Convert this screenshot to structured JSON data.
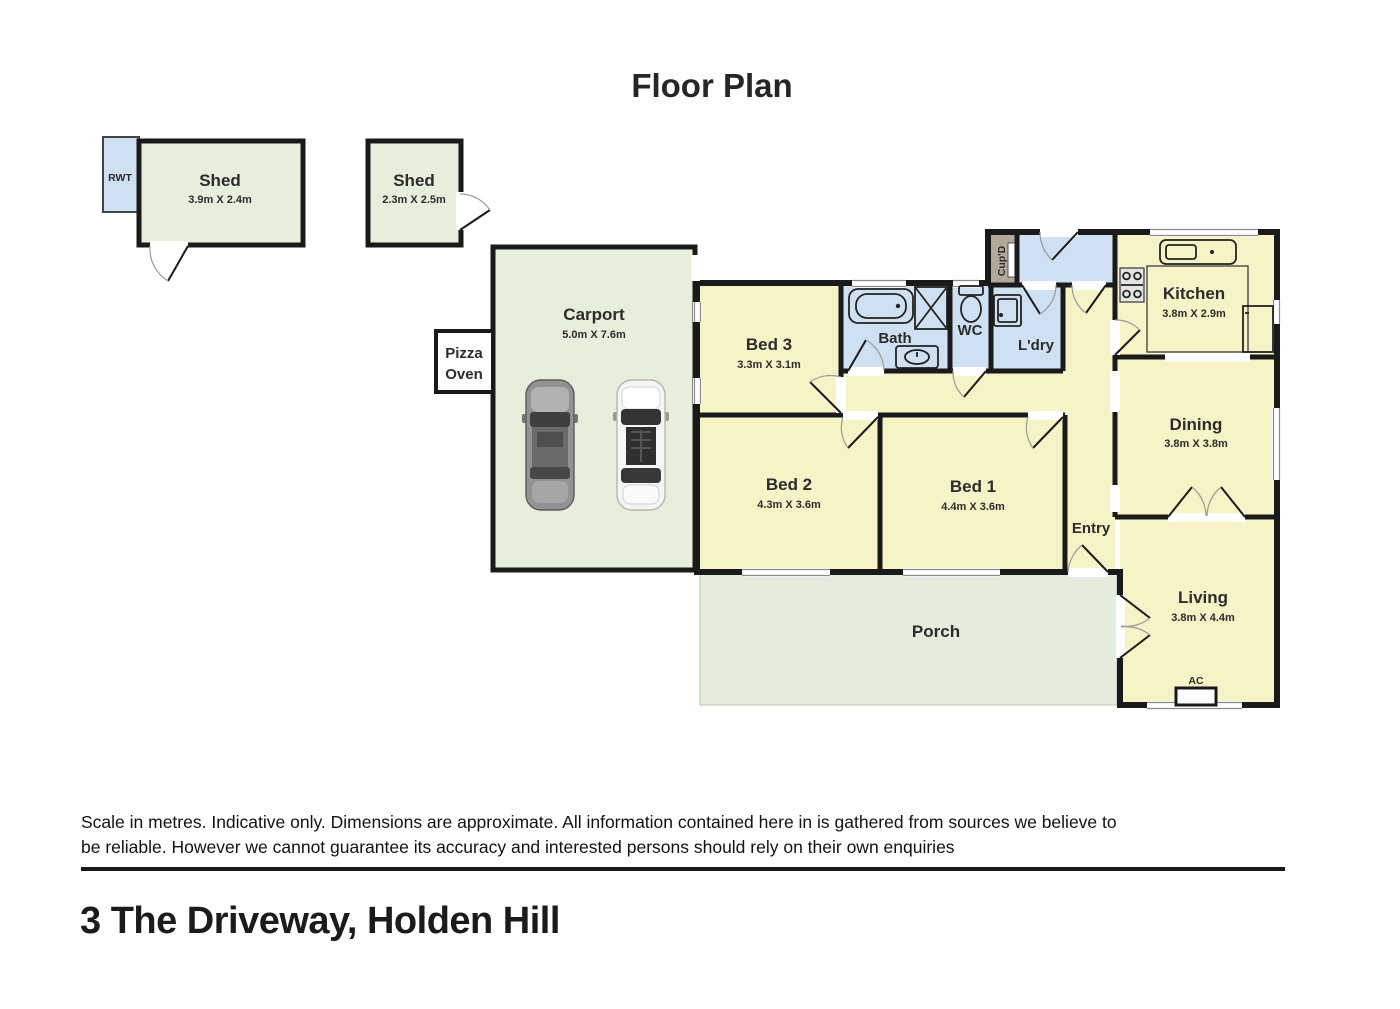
{
  "title": "Floor Plan",
  "colors": {
    "room_yellow": "#f6f3c6",
    "wet_area_blue": "#cfe0f2",
    "outdoor_green": "#e7eedb",
    "porch_green": "#e4ecdd",
    "cupboard_tan": "#b3a99b",
    "wall_black": "#1a1a1a"
  },
  "outbuildings": {
    "rwt": {
      "label": "RWT"
    },
    "shed1": {
      "label": "Shed",
      "dims": "3.9m X 2.4m"
    },
    "shed2": {
      "label": "Shed",
      "dims": "2.3m X 2.5m"
    },
    "pizza_oven": {
      "line1": "Pizza",
      "line2": "Oven"
    }
  },
  "rooms": {
    "carport": {
      "label": "Carport",
      "dims": "5.0m X 7.6m"
    },
    "bed3": {
      "label": "Bed 3",
      "dims": "3.3m X 3.1m"
    },
    "bath": {
      "label": "Bath"
    },
    "wc": {
      "label": "WC"
    },
    "ldry": {
      "label": "L'dry"
    },
    "cupd": {
      "label": "Cup'D"
    },
    "kitchen": {
      "label": "Kitchen",
      "dims": "3.8m X 2.9m"
    },
    "dining": {
      "label": "Dining",
      "dims": "3.8m X 3.8m"
    },
    "bed2": {
      "label": "Bed 2",
      "dims": "4.3m X 3.6m"
    },
    "bed1": {
      "label": "Bed 1",
      "dims": "4.4m X 3.6m"
    },
    "entry": {
      "label": "Entry"
    },
    "living": {
      "label": "Living",
      "dims": "3.8m X 4.4m"
    },
    "porch": {
      "label": "Porch"
    },
    "ac": {
      "label": "AC"
    }
  },
  "footer": {
    "disclaimer": "Scale in metres. Indicative only. Dimensions are approximate. All information contained here in is gathered from sources we believe to be reliable. However we cannot guarantee its accuracy and interested persons should rely on their own enquiries",
    "address": "3 The Driveway, Holden Hill"
  }
}
